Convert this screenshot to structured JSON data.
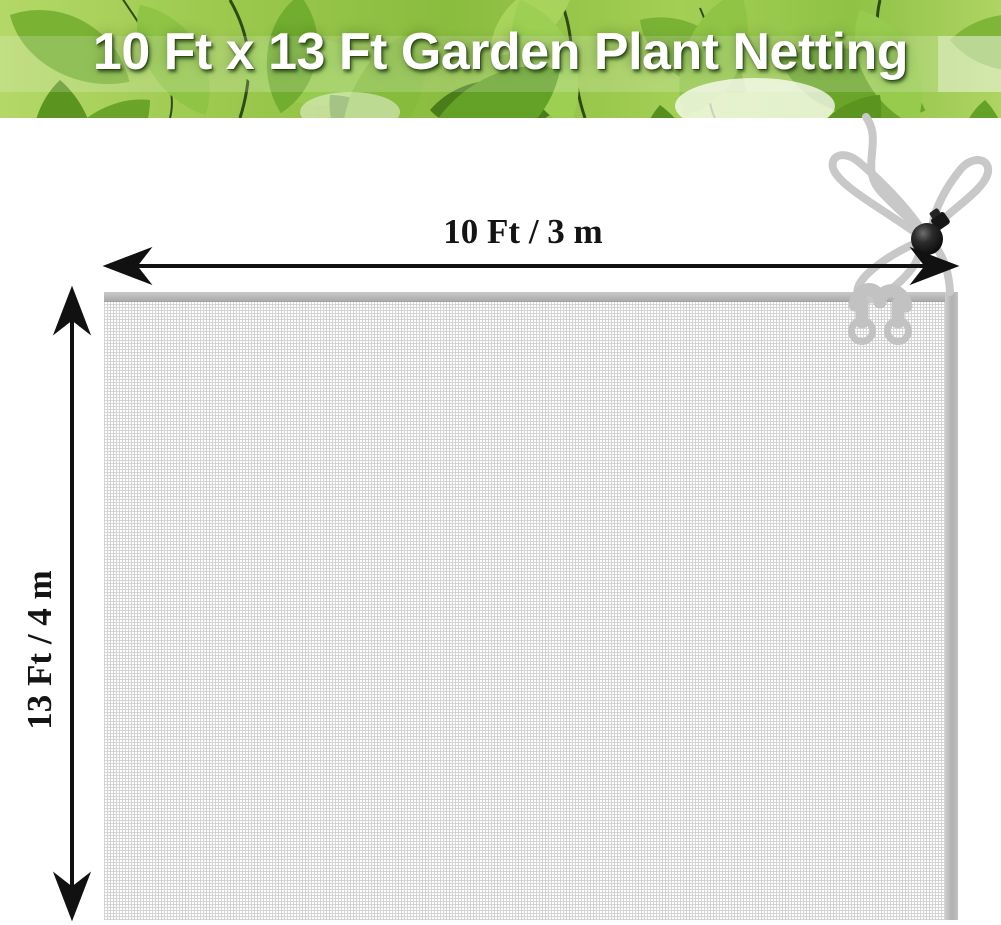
{
  "banner": {
    "title": "10 Ft x 13 Ft Garden Plant Netting"
  },
  "dimension_annotations": {
    "width_label": "10 Ft / 3 m",
    "height_label": "13 Ft / 4 m"
  },
  "colors": {
    "title_text": "#ffffff",
    "banner_green": "#8abc3e",
    "banner_green_light": "#a9d45c",
    "banner_green_dark": "#4a7d1a",
    "arrow_black": "#111111",
    "mesh_bg": "#fefefe",
    "mesh_line": "#d4d4d4",
    "hem_gray": "#ababab",
    "cord_gray": "#c8c8c8",
    "ring_gray": "#c2c2c2",
    "cord_lock_black": "#161616"
  }
}
